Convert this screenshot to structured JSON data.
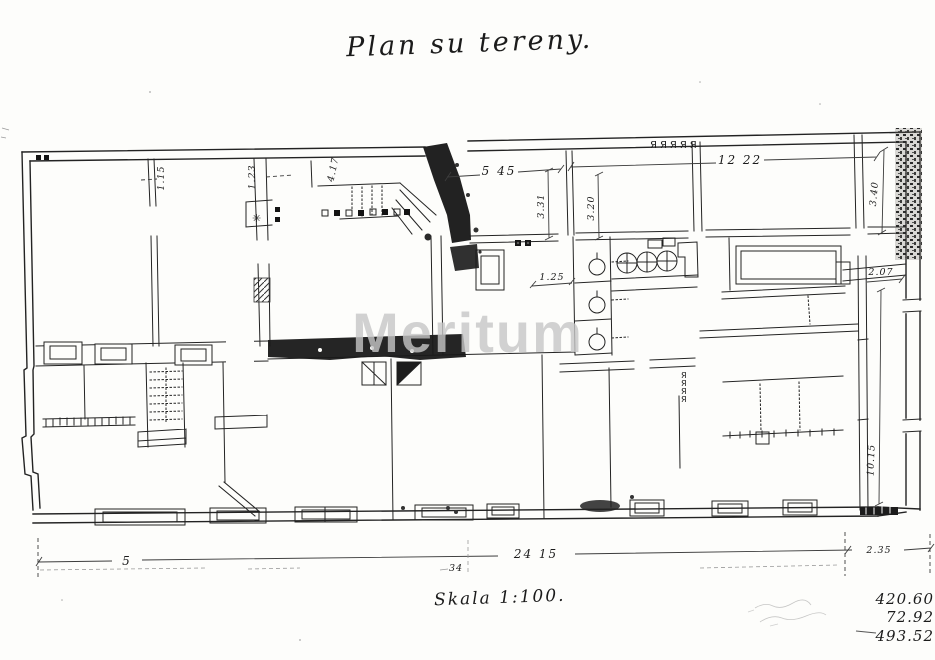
{
  "document": {
    "title": "Plan su tereny.",
    "scale_label": "Skala 1:100.",
    "watermark": "Meritum"
  },
  "dimensions": {
    "entry_width": "5 45",
    "top_right_width": "12 22",
    "room_331": "3.31",
    "room_320": "3.20",
    "room_340": "3.40",
    "passage_207": "2.07",
    "strip_1015": "10.15",
    "wall_115": "1.15",
    "wall_123": "1.23",
    "stair_417": "4.17",
    "corridor_125": "1.25",
    "bottom_left": "5",
    "bottom_total": "24 15",
    "bottom_note": "34",
    "bottom_right": "2.35"
  },
  "handwritten_totals": {
    "line1": "420.60",
    "line2": "72.92",
    "line3": "493.52"
  },
  "symbols": {
    "vent_row": "ЯЯЯЯЯ",
    "vent_mark": "Я",
    "star_mark": "✳"
  },
  "colors": {
    "ink": "#232323",
    "paper": "#fdfdfb",
    "watermark": "#c7c7c7"
  }
}
